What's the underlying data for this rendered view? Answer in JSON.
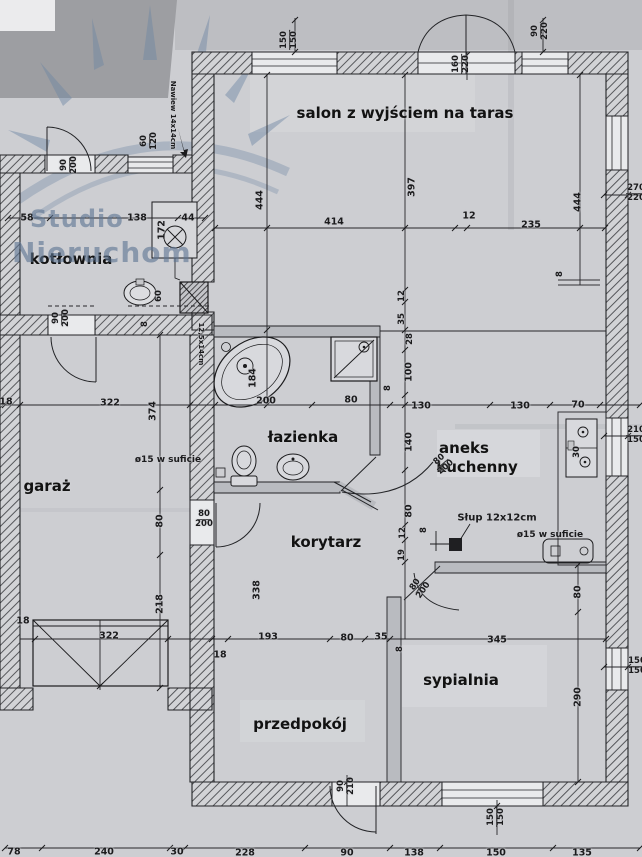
{
  "colors": {
    "paper": "#cdced2",
    "ink": "#1b1b1d",
    "watermark": "#6e86a4",
    "wall_hatch": "#55565a"
  },
  "watermark": {
    "line1": "Studio",
    "line2": "Nieruchom"
  },
  "room_labels": [
    {
      "t": "salon z wyjściem na taras",
      "x": 405,
      "y": 113
    },
    {
      "t": "kotłownia",
      "x": 71,
      "y": 259
    },
    {
      "t": "łazienka",
      "x": 303,
      "y": 437
    },
    {
      "t": "aneks",
      "x": 464,
      "y": 448
    },
    {
      "t": "kuchenny",
      "x": 477,
      "y": 467
    },
    {
      "t": "garaż",
      "x": 47,
      "y": 486
    },
    {
      "t": "korytarz",
      "x": 326,
      "y": 542
    },
    {
      "t": "sypialnia",
      "x": 461,
      "y": 680
    },
    {
      "t": "przedpokój",
      "x": 300,
      "y": 724
    }
  ],
  "dimension_labels": [
    {
      "t": "58",
      "x": 27,
      "y": 218
    },
    {
      "t": "138",
      "x": 137,
      "y": 218
    },
    {
      "t": "44",
      "x": 188,
      "y": 218
    },
    {
      "t": "414",
      "x": 334,
      "y": 222
    },
    {
      "t": "12",
      "x": 469,
      "y": 216
    },
    {
      "t": "235",
      "x": 531,
      "y": 225
    },
    {
      "t": "444",
      "x": 260,
      "y": 200,
      "r": -90
    },
    {
      "t": "397",
      "x": 412,
      "y": 187,
      "r": -90
    },
    {
      "t": "444",
      "x": 578,
      "y": 202,
      "r": -90
    },
    {
      "t": "172",
      "x": 162,
      "y": 230,
      "r": -90
    },
    {
      "t": "Nawiew 14x14cm",
      "x": 173,
      "y": 115,
      "r": 90,
      "s": 7
    },
    {
      "t": "60",
      "x": 159,
      "y": 296,
      "r": -90,
      "s": 8.5
    },
    {
      "t": "8",
      "x": 145,
      "y": 324,
      "r": -90,
      "s": 8.5
    },
    {
      "t": "12,5x14cm",
      "x": 201,
      "y": 344,
      "r": 90,
      "s": 7
    },
    {
      "t": "18",
      "x": 6,
      "y": 402
    },
    {
      "t": "322",
      "x": 110,
      "y": 403
    },
    {
      "t": "374",
      "x": 153,
      "y": 411,
      "r": -90
    },
    {
      "t": "200",
      "x": 266,
      "y": 401
    },
    {
      "t": "80",
      "x": 351,
      "y": 400
    },
    {
      "t": "130",
      "x": 421,
      "y": 406
    },
    {
      "t": "130",
      "x": 520,
      "y": 406
    },
    {
      "t": "70",
      "x": 578,
      "y": 405
    },
    {
      "t": "30",
      "x": 577,
      "y": 452,
      "r": -90,
      "s": 8.5
    },
    {
      "t": "8",
      "x": 560,
      "y": 274,
      "r": -90,
      "s": 8.5
    },
    {
      "t": "184",
      "x": 253,
      "y": 378,
      "r": -90
    },
    {
      "t": "8",
      "x": 388,
      "y": 388,
      "r": -90,
      "s": 8.5
    },
    {
      "t": "12",
      "x": 402,
      "y": 296,
      "r": -90,
      "s": 8.5
    },
    {
      "t": "35",
      "x": 402,
      "y": 319,
      "r": -90,
      "s": 8.5
    },
    {
      "t": "28",
      "x": 410,
      "y": 339,
      "r": -90,
      "s": 8.5
    },
    {
      "t": "100",
      "x": 409,
      "y": 372,
      "r": -90
    },
    {
      "t": "140",
      "x": 409,
      "y": 442,
      "r": -90
    },
    {
      "t": "80",
      "x": 409,
      "y": 511,
      "r": -90
    },
    {
      "t": "12",
      "x": 403,
      "y": 533,
      "r": -90,
      "s": 8.5
    },
    {
      "t": "19",
      "x": 402,
      "y": 555,
      "r": -90,
      "s": 8.5
    },
    {
      "t": "8",
      "x": 424,
      "y": 530,
      "r": -90,
      "s": 8.5
    },
    {
      "t": "Słup 12x12cm",
      "x": 497,
      "y": 518,
      "s": 10
    },
    {
      "t": "ø15 w suficie",
      "x": 550,
      "y": 535,
      "s": 9
    },
    {
      "t": "ø15 w suficie",
      "x": 168,
      "y": 460,
      "s": 9
    },
    {
      "t": "80",
      "x": 160,
      "y": 521,
      "r": -90
    },
    {
      "t": "218",
      "x": 160,
      "y": 604,
      "r": -90
    },
    {
      "t": "338",
      "x": 257,
      "y": 590,
      "r": -90
    },
    {
      "t": "18",
      "x": 23,
      "y": 621
    },
    {
      "t": "322",
      "x": 109,
      "y": 636
    },
    {
      "t": "18",
      "x": 220,
      "y": 655
    },
    {
      "t": "193",
      "x": 268,
      "y": 637
    },
    {
      "t": "80",
      "x": 347,
      "y": 638
    },
    {
      "t": "35",
      "x": 381,
      "y": 637
    },
    {
      "t": "8",
      "x": 400,
      "y": 649,
      "r": -90,
      "s": 8.5
    },
    {
      "t": "345",
      "x": 497,
      "y": 640
    },
    {
      "t": "80",
      "x": 578,
      "y": 592,
      "r": -90
    },
    {
      "t": "290",
      "x": 578,
      "y": 697,
      "r": -90
    },
    {
      "t": "78",
      "x": 14,
      "y": 852
    },
    {
      "t": "240",
      "x": 104,
      "y": 852
    },
    {
      "t": "30",
      "x": 177,
      "y": 852
    },
    {
      "t": "228",
      "x": 245,
      "y": 853
    },
    {
      "t": "90",
      "x": 347,
      "y": 853
    },
    {
      "t": "138",
      "x": 414,
      "y": 853
    },
    {
      "t": "150",
      "x": 496,
      "y": 853
    },
    {
      "t": "135",
      "x": 582,
      "y": 853
    }
  ],
  "fraction_labels": [
    {
      "top": "150",
      "bot": "150",
      "x": 290,
      "y": 40,
      "r": -90
    },
    {
      "top": "160",
      "bot": "220",
      "x": 462,
      "y": 64,
      "r": -90
    },
    {
      "top": "90",
      "bot": "220",
      "x": 541,
      "y": 31,
      "r": -90
    },
    {
      "top": "60",
      "bot": "120",
      "x": 150,
      "y": 141,
      "r": -90
    },
    {
      "top": "90",
      "bot": "200",
      "x": 70,
      "y": 165,
      "r": -90
    },
    {
      "top": "90",
      "bot": "200",
      "x": 62,
      "y": 318,
      "r": -90
    },
    {
      "top": "80",
      "bot": "200",
      "x": 204,
      "y": 520,
      "r": 0
    },
    {
      "top": "80",
      "bot": "200",
      "x": 443,
      "y": 464,
      "r": -40
    },
    {
      "top": "80",
      "bot": "200",
      "x": 420,
      "y": 588,
      "r": -55
    },
    {
      "top": "90",
      "bot": "210",
      "x": 347,
      "y": 786,
      "r": -90
    },
    {
      "top": "150",
      "bot": "150",
      "x": 497,
      "y": 817,
      "r": -90
    },
    {
      "top": "150",
      "bot": "150",
      "x": 637,
      "y": 667,
      "r": 0
    },
    {
      "top": "270",
      "bot": "220",
      "x": 636,
      "y": 194,
      "r": 0
    },
    {
      "top": "210",
      "bot": "150",
      "x": 636,
      "y": 436,
      "r": 0
    }
  ]
}
